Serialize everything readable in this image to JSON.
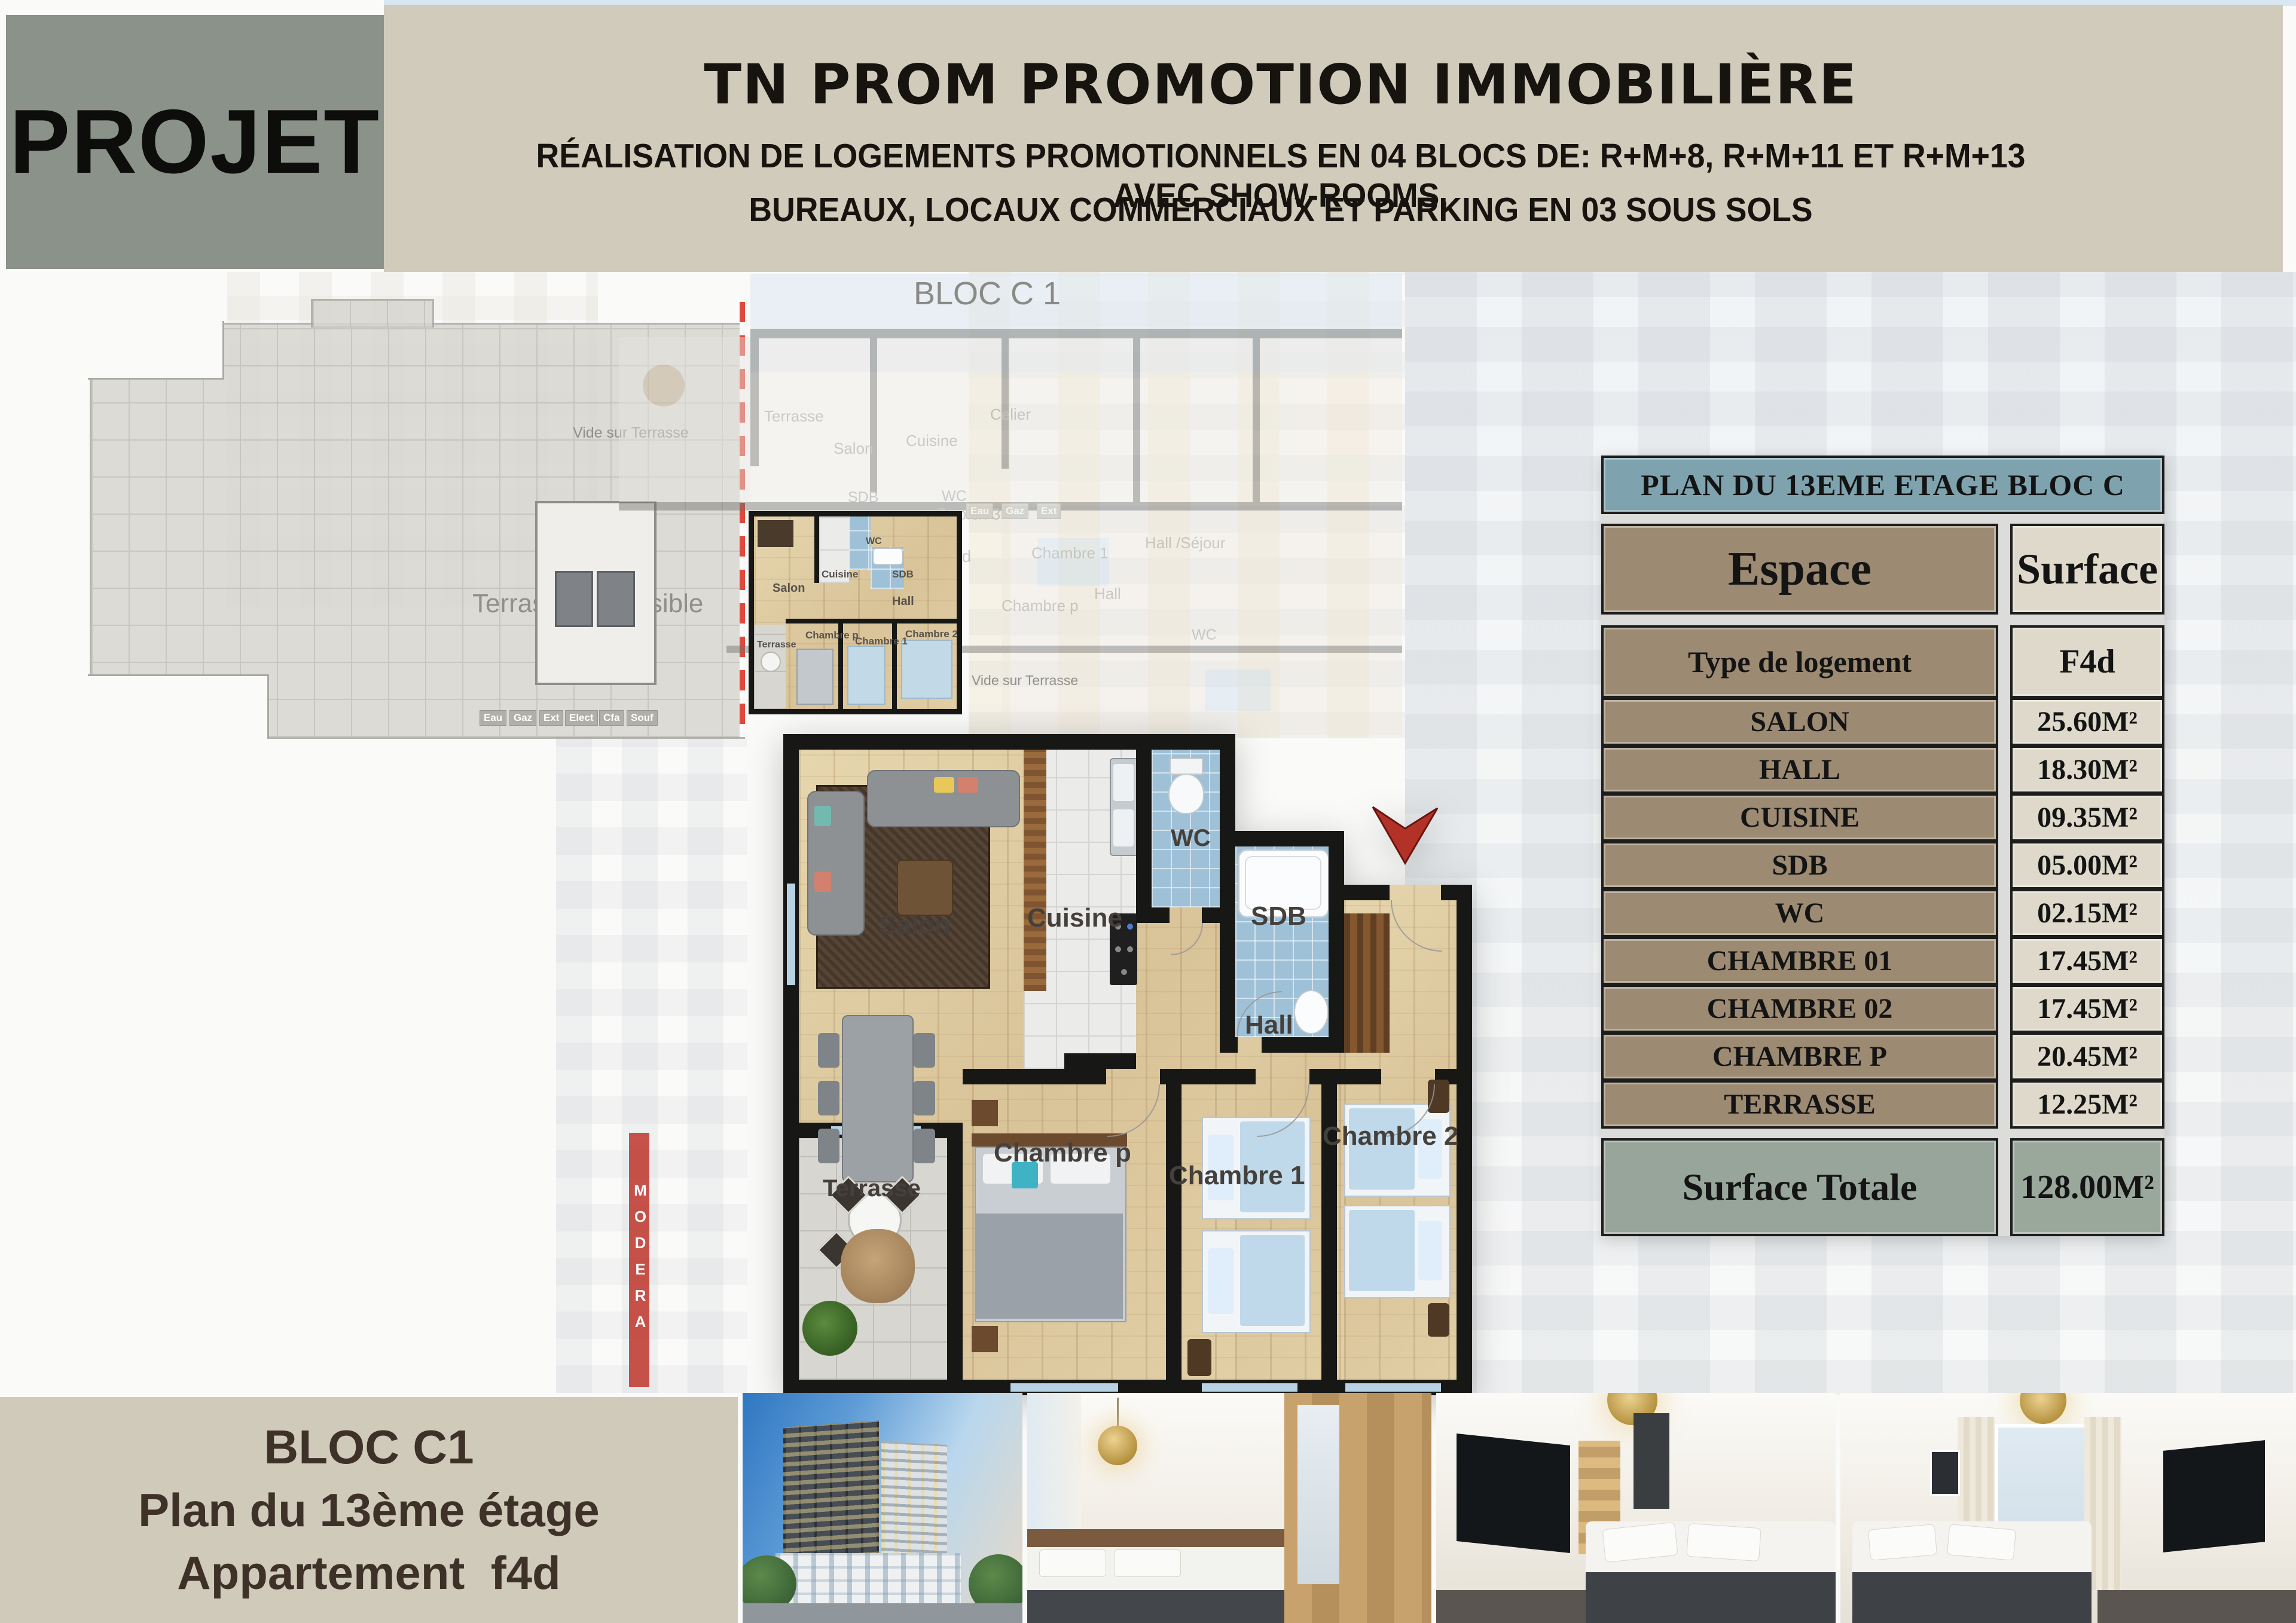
{
  "header": {
    "projet": "PROJET",
    "title": "TN PROM PROMOTION IMMOBILIÈRE",
    "subtitle1": "RÉALISATION DE LOGEMENTS PROMOTIONNELS EN 04 BLOCS DE: R+M+8, R+M+11 ET R+M+13 AVEC SHOW-ROOMS,",
    "subtitle2": "BUREAUX, LOCAUX COMMERCIAUX ET PARKING EN 03 SOUS SOLS"
  },
  "overview": {
    "bloc_label": "BLOC C 1",
    "terrace_label": "Terrasse accessible",
    "vide_top": "Vide sur Terrasse",
    "vide_bottom": "Vide sur Terrasse",
    "watermark_sign": "MODERA",
    "core_badges": [
      "Eau",
      "Gaz",
      "Ext",
      "Elect",
      "Cfa",
      "Souf"
    ],
    "faded_labels": [
      "Terrasse",
      "Salon",
      "Cuisine",
      "Celier",
      "Chambre 1",
      "Hall /Séjour",
      "Chambre p",
      "Hall",
      "SDB",
      "WC",
      "WC",
      "Duplex 3",
      "F3e",
      "F4d"
    ],
    "faded_badges": [
      "Eau",
      "Gaz",
      "Ext"
    ],
    "mini_labels": [
      "Salon",
      "Cuisine",
      "WC",
      "SDB",
      "Hall",
      "Chambre p",
      "Chambre 1",
      "Chambre 2",
      "Terrasse"
    ]
  },
  "plan": {
    "labels": {
      "salon": "Salon",
      "cuisine": "Cuisine",
      "wc": "WC",
      "sdb": "SDB",
      "hall": "Hall",
      "chambre_p": "Chambre p",
      "chambre_1": "Chambre 1",
      "chambre_2": "Chambre 2",
      "terrasse": "Terrasse"
    }
  },
  "table": {
    "title": "PLAN DU 13EME ETAGE  BLOC C",
    "col_espace": "Espace",
    "col_surface": "Surface",
    "rows": [
      {
        "label": "Type de logement",
        "value": "F4d"
      },
      {
        "label": "SALON",
        "value": "25.60M²"
      },
      {
        "label": "HALL",
        "value": "18.30M²"
      },
      {
        "label": "CUISINE",
        "value": "09.35M²"
      },
      {
        "label": "SDB",
        "value": "05.00M²"
      },
      {
        "label": "WC",
        "value": "02.15M²"
      },
      {
        "label": "CHAMBRE 01",
        "value": "17.45M²"
      },
      {
        "label": "CHAMBRE 02",
        "value": "17.45M²"
      },
      {
        "label": "CHAMBRE P",
        "value": "20.45M²"
      },
      {
        "label": "TERRASSE",
        "value": "12.25M²"
      }
    ],
    "total_label": "Surface Totale",
    "total_value": "128.00M²"
  },
  "footer": {
    "line1": "BLOC C1",
    "line2": "Plan du 13ème étage",
    "line3": "Appartement  f4d"
  },
  "colors": {
    "band": "#d1cbbc",
    "projet_box": "#8b9289",
    "table_header": "#7ea3ae",
    "espace_cell": "#9c8a72",
    "surface_cell": "#ded9cb",
    "total_row": "#97a59a",
    "arrow_red": "#b23228",
    "dashed_red": "#e0493e"
  }
}
